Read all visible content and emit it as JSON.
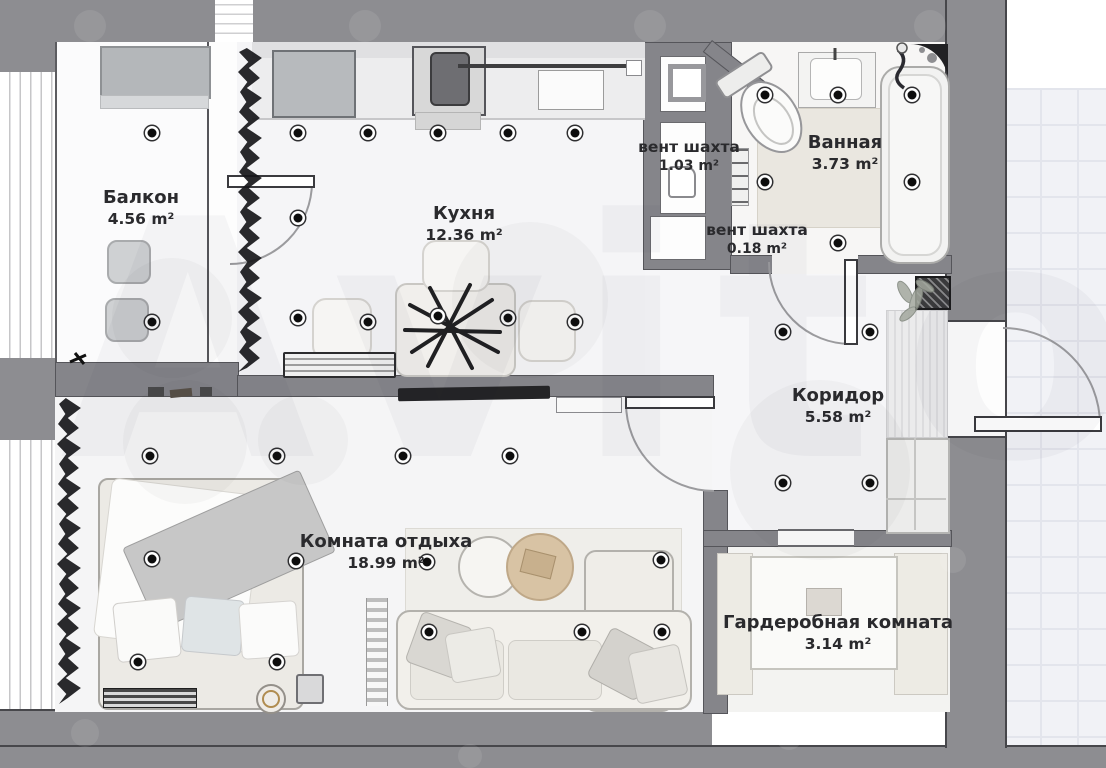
{
  "plan": {
    "watermark": "Avito",
    "rooms": [
      {
        "id": "balcony",
        "name": "Балкон",
        "area": "4.56 m²"
      },
      {
        "id": "kitchen",
        "name": "Кухня",
        "area": "12.36 m²"
      },
      {
        "id": "vent-shaft-1",
        "name": "вент шахта",
        "area": "1.03 m²"
      },
      {
        "id": "bathroom",
        "name": "Ванная",
        "area": "3.73 m²"
      },
      {
        "id": "vent-shaft-2",
        "name": "вент шахта",
        "area": "0.18 m²"
      },
      {
        "id": "corridor",
        "name": "Коридор",
        "area": "5.58 m²"
      },
      {
        "id": "lounge",
        "name": "Комната отдыха",
        "area": "18.99 m²"
      },
      {
        "id": "wardrobe",
        "name": "Гардеробная комната",
        "area": "3.14 m²"
      }
    ],
    "colors": {
      "outer_wall": "#8d8d91",
      "partition_wall": "#85858a",
      "floor": "#f6f6f8",
      "exterior_tile": "#f1f2f6",
      "wood_accent": "#d8c3a4",
      "label_text": "#2a2a2d"
    }
  }
}
